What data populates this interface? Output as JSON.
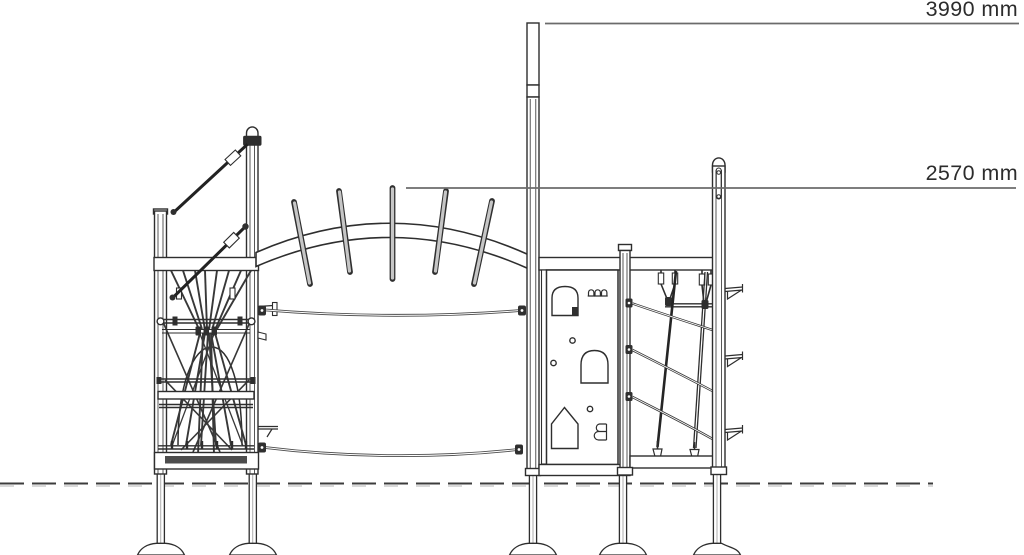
{
  "drawing": {
    "type": "technical-elevation",
    "subject": "playground climbing structure side elevation",
    "background_color": "#ffffff",
    "line_color": "#2e2e2e",
    "dimension_line_color": "#6b6b6b",
    "text_color": "#2c2c2c",
    "ground_line_style": "dashed",
    "dimensions": [
      {
        "id": "overall-height",
        "label": "3990 mm",
        "value": 3990,
        "unit": "mm"
      },
      {
        "id": "arch-height",
        "label": "2570 mm",
        "value": 2570,
        "unit": "mm"
      }
    ]
  }
}
